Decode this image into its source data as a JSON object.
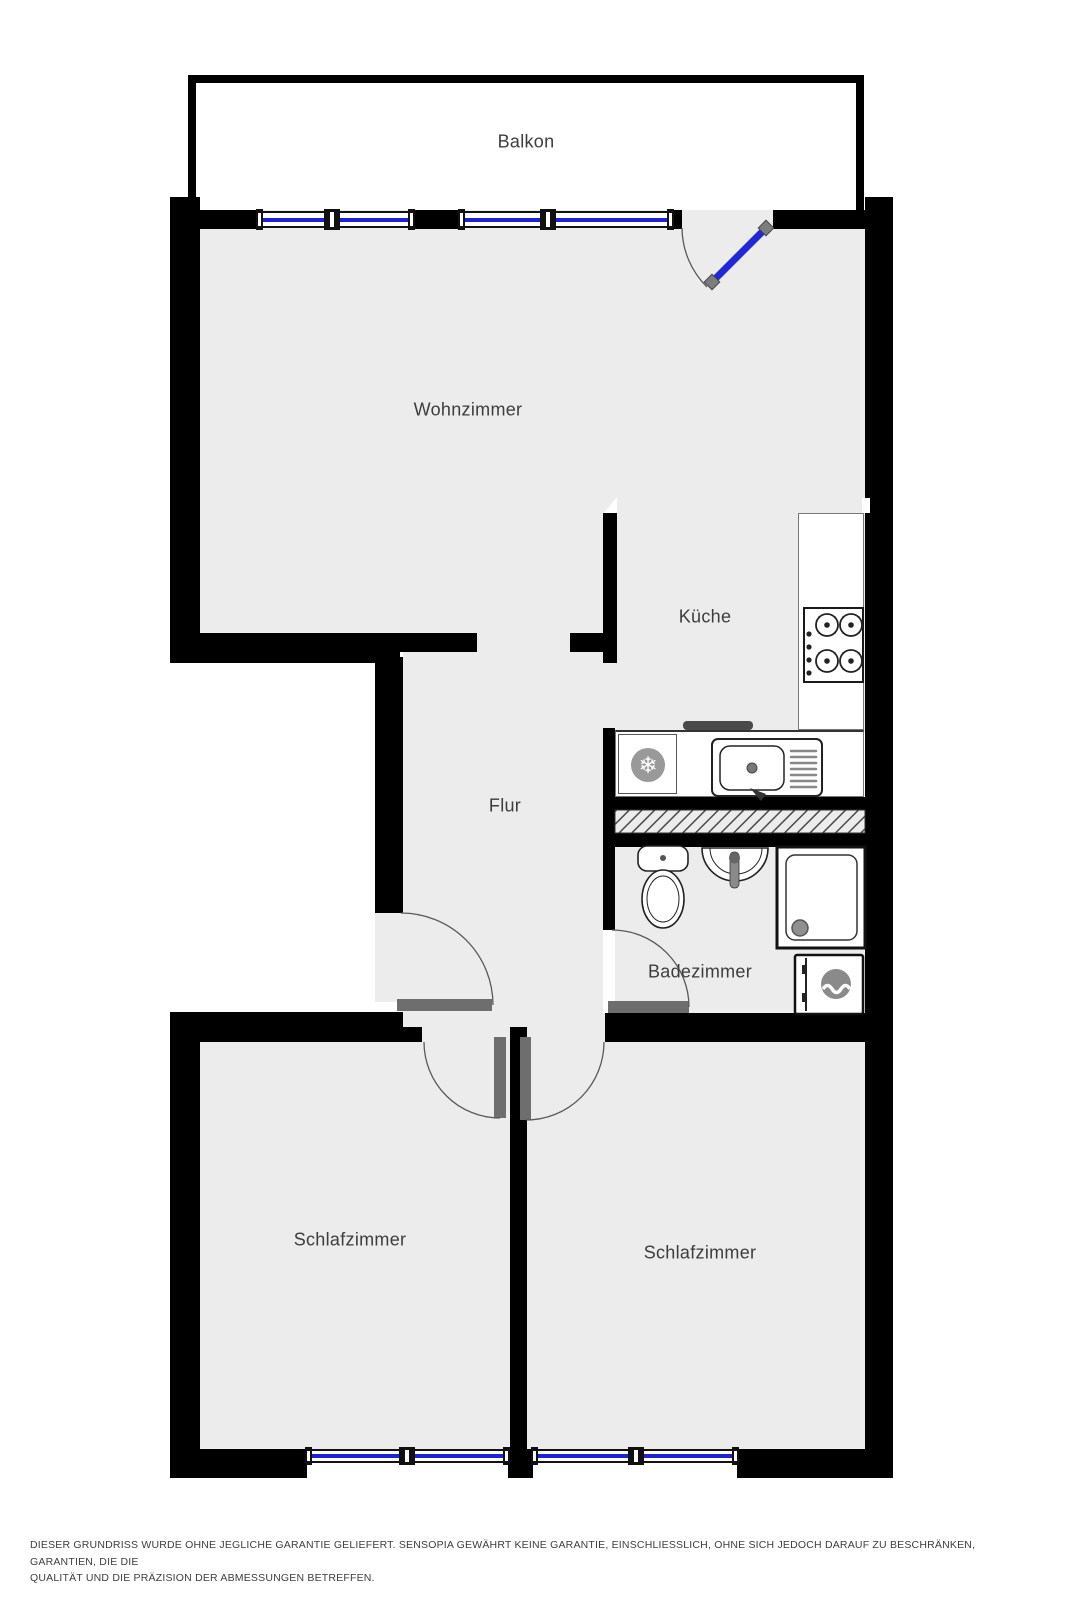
{
  "rooms": {
    "balkon": "Balkon",
    "wohnzimmer": "Wohnzimmer",
    "kueche": "Küche",
    "flur": "Flur",
    "badezimmer": "Badezimmer",
    "schlafzimmer_links": "Schlafzimmer",
    "schlafzimmer_rechts": "Schlafzimmer"
  },
  "disclaimer": {
    "line1": "DIESER GRUNDRISS WURDE OHNE JEGLICHE GARANTIE GELIEFERT. SENSOPIA GEWÄHRT KEINE GARANTIE, EINSCHLIESSLICH, OHNE SICH JEDOCH DARAUF ZU BESCHRÄNKEN, GARANTIEN, DIE DIE",
    "line2": "QUALITÄT UND DIE PRÄZISION DER ABMESSUNGEN BETREFFEN."
  },
  "colors": {
    "wall": "#000000",
    "floor": "#ececec",
    "window_blue": "#1e22d4",
    "balcony_door_blue": "#2328d6",
    "door_leaf_gray": "#6e6e6e",
    "fixture_gray": "#8a8a8a",
    "label_text": "#3d3d3d"
  },
  "icons": {
    "fridge_snowflake": "❄"
  }
}
